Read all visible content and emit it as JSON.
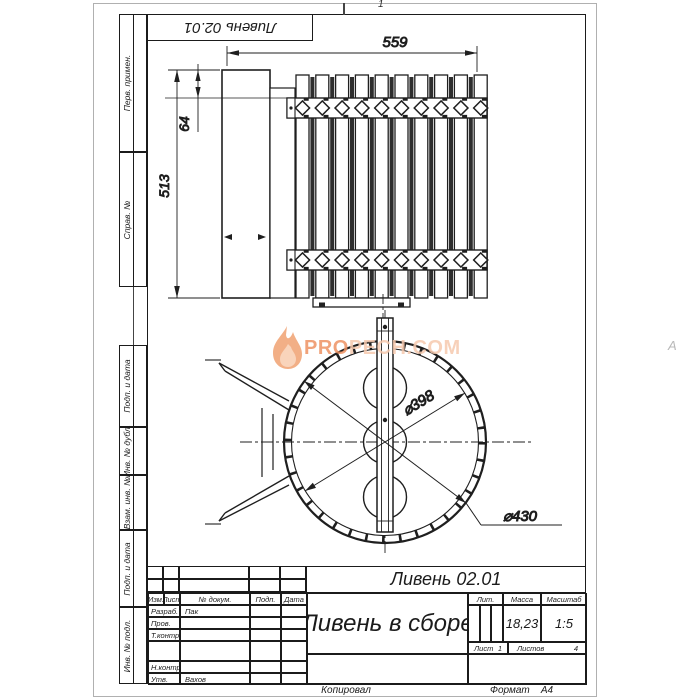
{
  "stamp_rotated": "Ливень 02.01",
  "zone_top": "1",
  "zone_right": "А",
  "side_labels": [
    "Перв. примен.",
    "Справ. №",
    "Подп. и дата",
    "Инв. № дубл.",
    "Взам. инв. №",
    "Подп. и дата",
    "Инв. № подл."
  ],
  "dimensions": {
    "width": "559",
    "height": "513",
    "offset": "64",
    "inner_dia": "⌀398",
    "outer_dia": "⌀430"
  },
  "watermark": {
    "strong": "PRO",
    "light": "PECH.COM",
    "flame_color": "#f0a272",
    "flame_inner": "#f8cdb0"
  },
  "title_block": {
    "designation": "Ливень 02.01",
    "name": "Ливень в сборе",
    "headers": {
      "izm": "Изм.",
      "list": "Лист",
      "doc": "№ докум.",
      "podp": "Подп.",
      "data": "Дата"
    },
    "rows": [
      {
        "role": "Разраб.",
        "person": "Пак"
      },
      {
        "role": "Пров.",
        "person": ""
      },
      {
        "role": "Т.контр.",
        "person": ""
      },
      {
        "role": "Н.контр.",
        "person": ""
      },
      {
        "role": "Утв.",
        "person": "Вахов"
      }
    ],
    "lit_label": "Лит.",
    "mass_label": "Масса",
    "mass_value": "18,23",
    "scale_label": "Масштаб",
    "scale_value": "1:5",
    "sheet_label": "Лист",
    "sheet_value": "1",
    "sheets_label": "Листов",
    "sheets_value": "4",
    "footer_copy": "Копировал",
    "footer_format_label": "Формат",
    "footer_format_value": "А4"
  }
}
